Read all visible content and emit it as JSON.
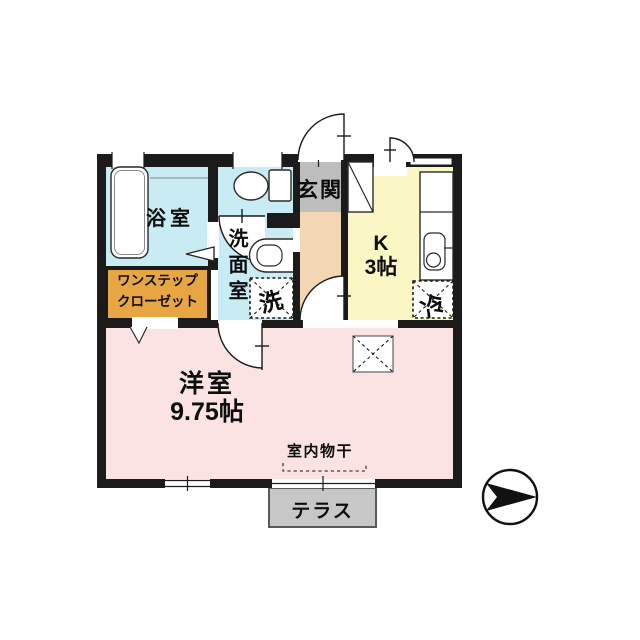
{
  "plan_title": "1K apartment floor plan",
  "rooms": {
    "bathroom": {
      "label": "浴室"
    },
    "closet": {
      "label_line1": "ワンステップ",
      "label_line2": "クローゼット"
    },
    "washroom": {
      "label": "洗面室"
    },
    "washer": {
      "label": "洗"
    },
    "entrance": {
      "label": "玄関"
    },
    "kitchen": {
      "label_line1": "K",
      "label_line2": "3帖"
    },
    "fridge": {
      "label": "冷"
    },
    "main_room": {
      "label_line1": "洋室",
      "label_line2": "9.75帖"
    },
    "drying": {
      "label": "室内物干"
    },
    "terrace": {
      "label": "テラス"
    }
  },
  "fixtures": [
    "bathtub",
    "toilet",
    "washbasin-sink",
    "kitchen-counter-sink",
    "washing-machine-space",
    "refrigerator-space",
    "shoe-cabinet",
    "ceiling-hatch",
    "indoor-drying-rail",
    "compass-arrow"
  ],
  "colors": {
    "wall": "#1b1b1b",
    "bathroom_blue": "#c9ebf3",
    "kitchen_yellow": "#faf7c5",
    "main_room_pink": "#fae3e2",
    "hallway_peach": "#f3d7b4",
    "entrance_gray": "#bdbdbd",
    "terrace_gray": "#c7c7c7",
    "closet_orange": "#e8a544"
  }
}
